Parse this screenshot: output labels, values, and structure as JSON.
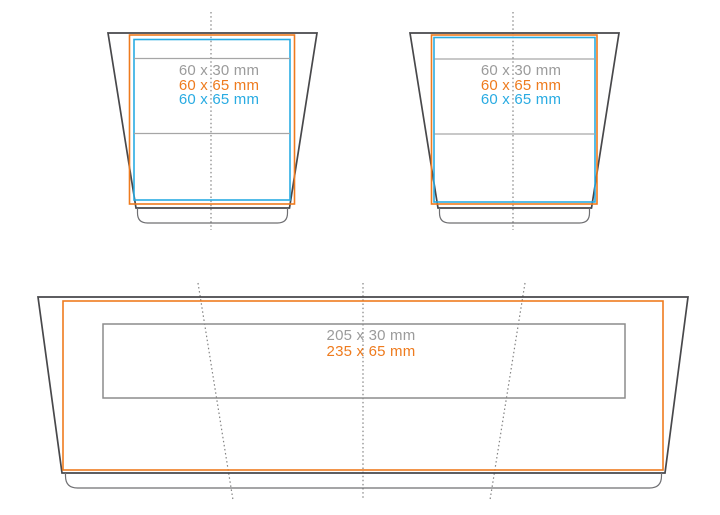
{
  "diagram": {
    "description_labels_only": "print area template with two tapered pot views and one long tray view",
    "units": "mm"
  },
  "colors": {
    "outline": "#48484b",
    "lip": "#6f6f72",
    "orange": "#ee7b1e",
    "cyan": "#29abe2",
    "label_gray": "#9b9b9b",
    "line_gray": "#8c8c8c",
    "band_gray": "#a6a6a6",
    "dotted_gray": "#828282"
  },
  "pot_front": {
    "labels": {
      "area1": "60 x 30 mm",
      "area2": "60 x 65 mm",
      "area3": "60 x 65 mm"
    }
  },
  "pot_back": {
    "labels": {
      "area1": "60 x 30 mm",
      "area2": "60 x 65 mm",
      "area3": "60 x 65 mm"
    }
  },
  "tray": {
    "labels": {
      "area1": "205 x 30 mm",
      "area2": "235 x 65 mm"
    }
  }
}
